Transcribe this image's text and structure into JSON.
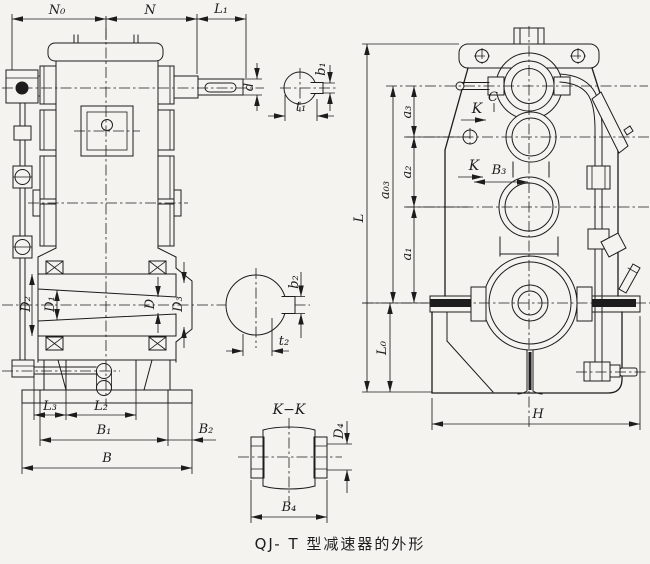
{
  "figure_caption": "QJ- T 型减速器的外形",
  "front": {
    "top": {
      "n0": "N₀",
      "n": "N",
      "l1": "L₁"
    },
    "shaft": {
      "d": "d"
    },
    "bores": {
      "d2": "D₂",
      "d1": "D₁",
      "d": "D",
      "d3": "D₃"
    },
    "bottom": {
      "l3": "L₃",
      "l2": "L₂",
      "b1": "B₁",
      "b2": "B₂",
      "b": "B"
    }
  },
  "sections": {
    "key1": {
      "b1": "b₁",
      "t1": "t₁"
    },
    "key2": {
      "b2": "b₂",
      "t2": "t₂"
    },
    "kk": {
      "title": "K−K",
      "d4": "D₄",
      "b4": "B₄"
    }
  },
  "side": {
    "l": "L",
    "l0": "L₀",
    "h": "H",
    "a03": "a₀₃",
    "a3": "a₃",
    "a2": "a₂",
    "a1": "a₁",
    "k_upper": "K",
    "k_lower": "K",
    "c": "C",
    "b3": "B₃"
  }
}
